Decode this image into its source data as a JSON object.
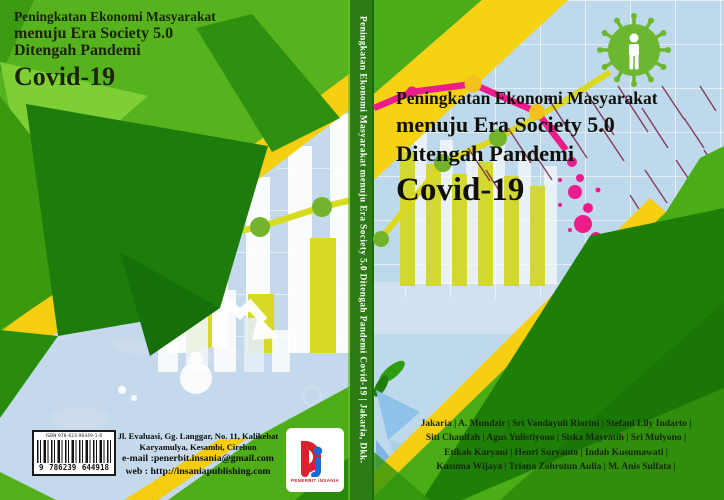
{
  "meta": {
    "kind": "book-cover-wrap",
    "width": 724,
    "height": 500
  },
  "back_cover": {
    "title_line1": "Peningkatan Ekonomi Masyarakat",
    "title_line2": "menuju Era Society 5.0",
    "title_line3": "Ditengah Pandemi",
    "title_line4": "Covid-19",
    "publisher_address_line1": "Jl. Evaluasi, Gg. Langgar, No. 11, Kalikebat",
    "publisher_address_line2": "Karyamulya, Kesambi, Cirebon",
    "publisher_email_line": "e-mail :penerbit.insania@gmail.com",
    "publisher_web_line": "web : http://insaniapublishing.com",
    "logo_text": "PENERBIT INSANIA",
    "isbn_label": "ISBN 978-623-96449-1-8",
    "barcode_digit_group1": "9",
    "barcode_digit_group2": "786239",
    "barcode_digit_group3": "644918"
  },
  "spine": {
    "text": "Peningkatan Ekonomi Masyarakat menuju Era Society 5.0 Ditengah Pandemi  Covid-19   | Jakaria, Dkk."
  },
  "front_cover": {
    "title_line1": "Peningkatan Ekonomi Masyarakat",
    "title_line2": "menuju Era Society 5.0",
    "title_line3": "Ditengah Pandemi",
    "title_line4": "Covid-19",
    "authors_line1": "Jakaria | A. Mundzir | Sri Vandayuli Riorini | Stefani Lily Indarto |",
    "authors_line2": "Siti Chanifah | Agus Yulistiyono | Siska Mayratih | Sri Mulyono |",
    "authors_line3": "Etikah Karyani | Henri Suryanto | Indah Kusumawati |",
    "authors_line4": "Kusuma Wijaya | Triana Zohrotun Aulia | M. Anis Sulfata |"
  },
  "colors": {
    "bright_green": "#4fae17",
    "dark_green": "#1e7c09",
    "spine_green": "#2b7c13",
    "yellow": "#f5cf10",
    "chartreuse": "#d6d925",
    "light_blue": "#bed9ec",
    "pink": "#ea1d8b",
    "dark_red_streak": "#7b2144",
    "logo_red": "#d8232f",
    "logo_blue": "#1a6ad1"
  }
}
